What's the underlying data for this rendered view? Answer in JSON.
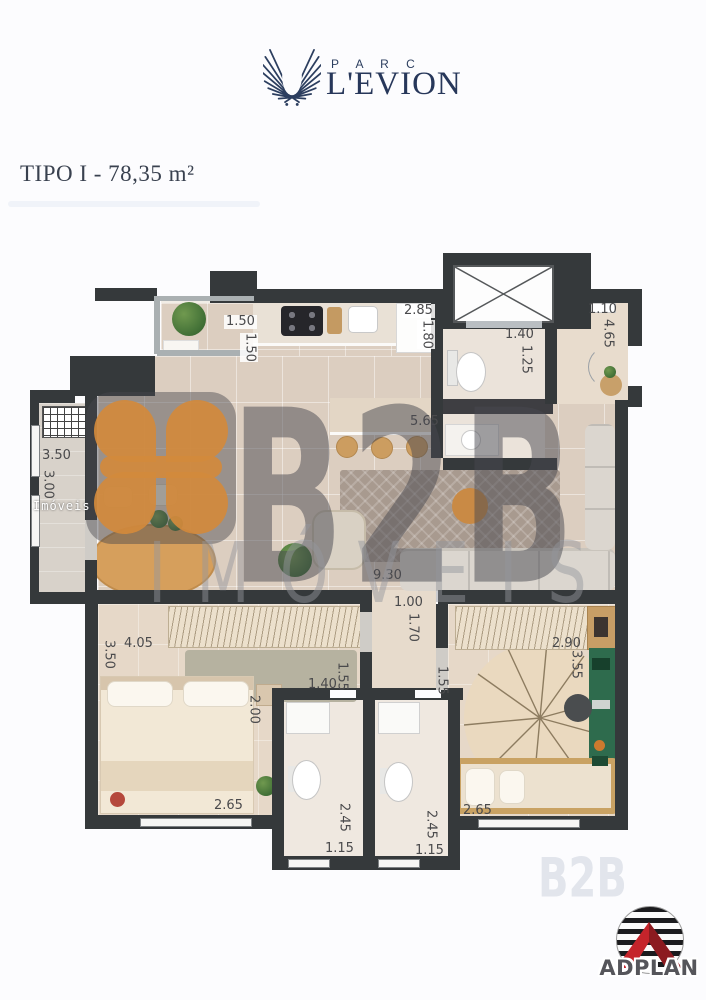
{
  "colors": {
    "brand_navy": "#2c3e5f",
    "wall": "#35393b",
    "watermark_orange": "#d28a3c",
    "adplan_red": "#c5242b"
  },
  "header": {
    "brand_top": "P A R C",
    "brand_name": "L'EVION"
  },
  "title": {
    "text": "TIPO I - 78,35 m²"
  },
  "watermark": {
    "big": "B2B",
    "sub": "IMÓVEIS",
    "small": "Imóveis",
    "faint": "B2B"
  },
  "footer": {
    "logo_text": "ADPLAN"
  },
  "plan": {
    "measurements": [
      {
        "id": "balcony-width",
        "v": "1.50"
      },
      {
        "id": "balcony-depth",
        "v": "1.50"
      },
      {
        "id": "bath-width",
        "v": "2.85"
      },
      {
        "id": "bath-depth",
        "v": "1.80"
      },
      {
        "id": "bath-door",
        "v": "1.40"
      },
      {
        "id": "bath-side",
        "v": "1.25"
      },
      {
        "id": "entry-width",
        "v": "1.10"
      },
      {
        "id": "entry-depth",
        "v": "4.65"
      },
      {
        "id": "living-width",
        "v": "5.65"
      },
      {
        "id": "service-width",
        "v": "3.50"
      },
      {
        "id": "service-depth",
        "v": "3.00"
      },
      {
        "id": "living-length",
        "v": "9.30"
      },
      {
        "id": "corridor-width",
        "v": "1.00"
      },
      {
        "id": "corridor-depth",
        "v": "1.70"
      },
      {
        "id": "bedroom1-width",
        "v": "4.05"
      },
      {
        "id": "bedroom1-depth",
        "v": "3.50"
      },
      {
        "id": "wc-offset",
        "v": "1.40"
      },
      {
        "id": "wc1-side",
        "v": "1.55"
      },
      {
        "id": "bedroom1-side",
        "v": "2.00"
      },
      {
        "id": "wc2-side",
        "v": "1.55"
      },
      {
        "id": "bedroom2-width",
        "v": "2.90"
      },
      {
        "id": "bedroom2-depth",
        "v": "3.55"
      },
      {
        "id": "bedroom1-bottom",
        "v": "2.65"
      },
      {
        "id": "wc1-length",
        "v": "2.45"
      },
      {
        "id": "wc1-width",
        "v": "1.15"
      },
      {
        "id": "wc2-length",
        "v": "2.45"
      },
      {
        "id": "wc2-width",
        "v": "1.15"
      },
      {
        "id": "bedroom2-bottom",
        "v": "2.65"
      }
    ]
  }
}
